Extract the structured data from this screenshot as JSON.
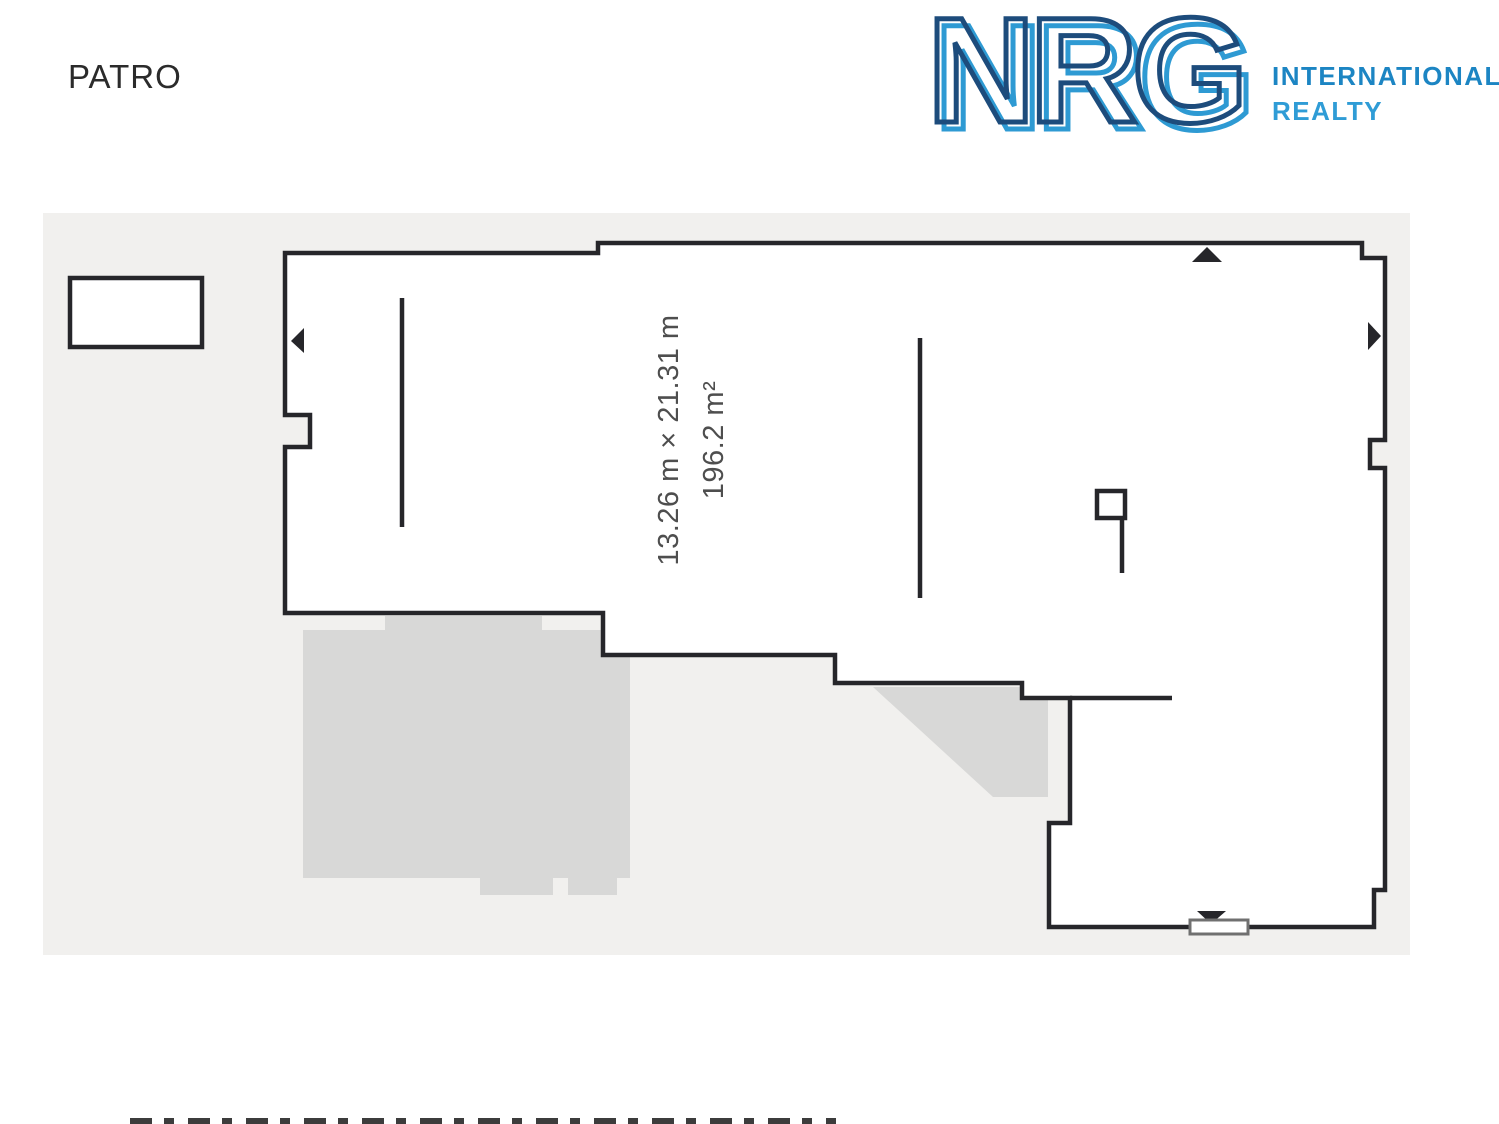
{
  "header": {
    "floor_label": "PATRO"
  },
  "logo": {
    "brand": "NRG",
    "line1": "INTERNATIONAL",
    "line2": "REALTY"
  },
  "floor_plan": {
    "dimensions": "13.26 m × 21.31 m",
    "area": "196.2 m²"
  },
  "colors": {
    "canvas_bg": "#f1f0ee",
    "wall": "#26262a",
    "underlay": "#d8d8d7",
    "dimension_text": "#4e4e4e",
    "floor_label_text": "#2b2b2b",
    "logo_dark": "#1d4c7c",
    "logo_light": "#2e9ad3",
    "logo_line1": "#1c85c3",
    "logo_line2": "#2f9cd6",
    "door_sill_border": "#707070"
  }
}
